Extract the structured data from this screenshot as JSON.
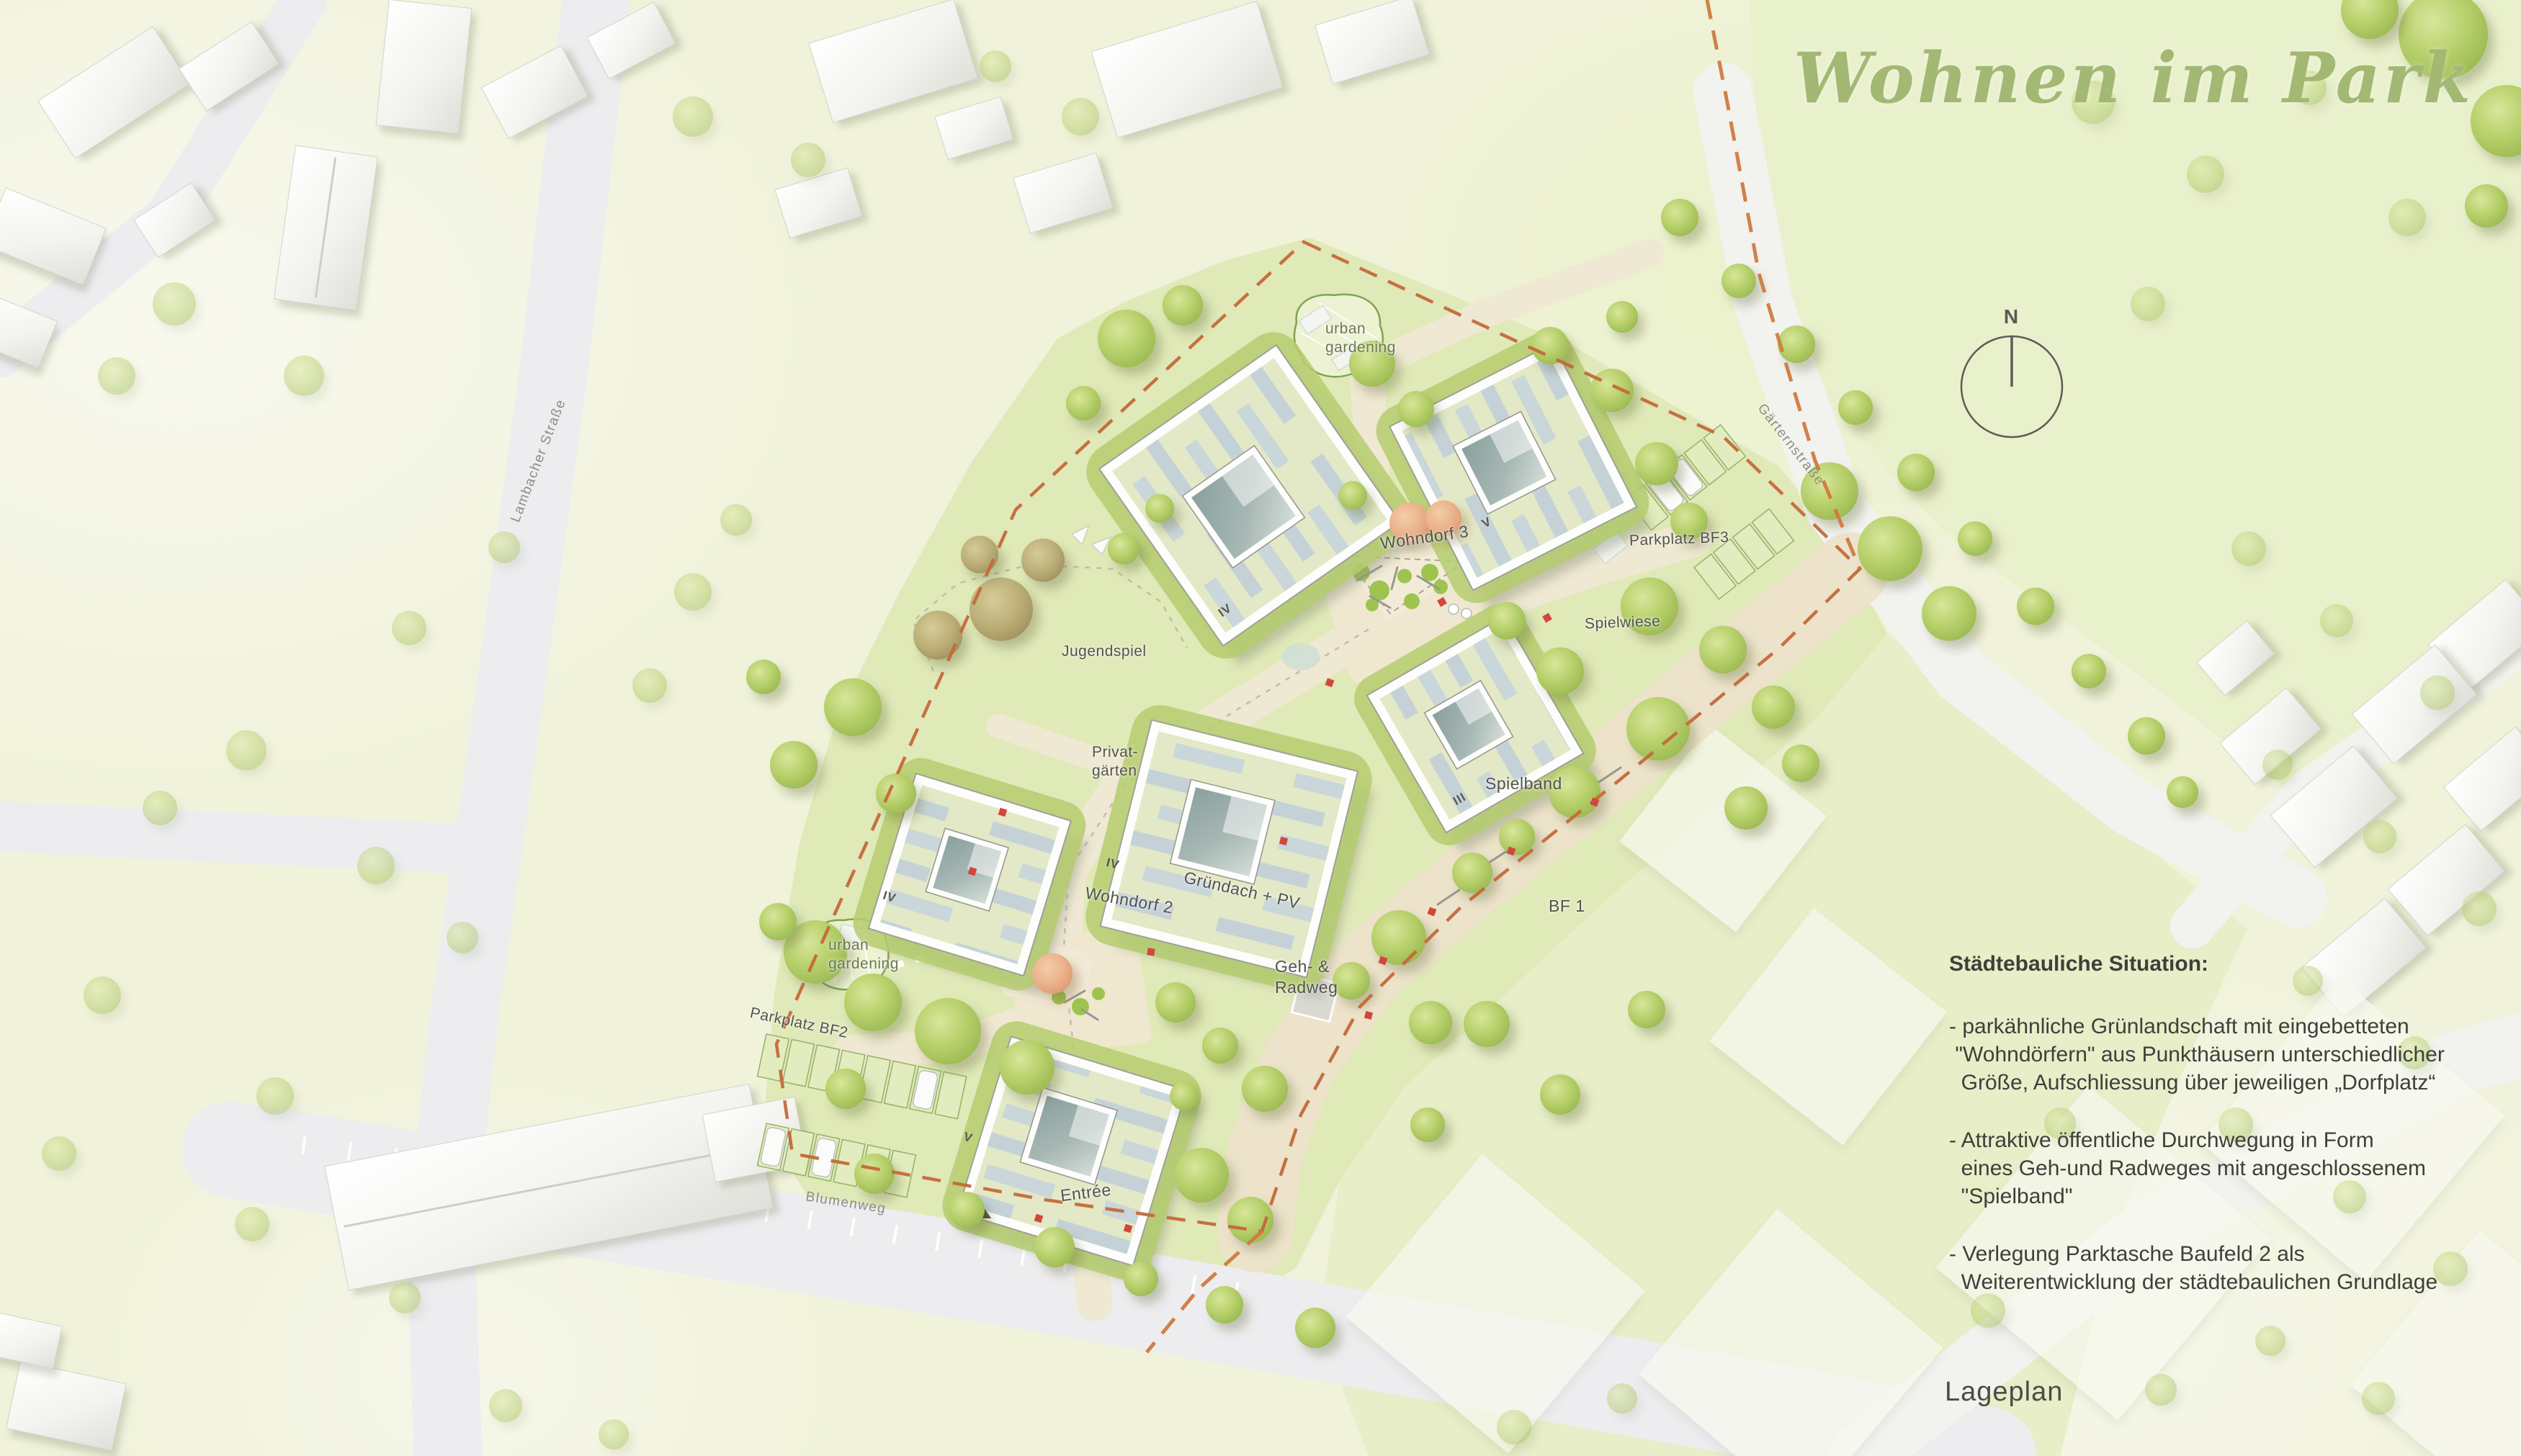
{
  "title": "Wohnen im Park",
  "caption": "Lageplan",
  "compass": {
    "north": "N"
  },
  "description": {
    "heading": "Städtebauliche Situation:",
    "bullets": [
      "- parkähnliche Grünlandschaft mit eingebetteten\n \"Wohndörfern\" aus Punkthäusern unterschiedlicher\n  Größe, Aufschliessung über jeweiligen „Dorfplatz“",
      "- Attraktive öffentliche Durchwegung in Form\n  eines Geh-und Radweges mit angeschlossenem\n  \"Spielband\"",
      "- Verlegung Parktasche Baufeld 2 als\n  Weiterentwicklung der städtebaulichen Grundlage"
    ]
  },
  "streets": {
    "lambacher": "Lambacher Straße",
    "gaertern": "Gärternstraße",
    "blumenweg": "Blumenweg"
  },
  "labels": {
    "wohndorf3": "Wohndorf 3",
    "wohndorf2": "Wohndorf 2",
    "gruendach": "Gründach + PV",
    "gehradweg": "Geh- &\nRadweg",
    "jugendspiel": "Jugendspiel",
    "privatgaerten": "Privat-\ngärten",
    "urban_gardening": "urban\ngardening",
    "parkplatz_bf3": "Parkplatz BF3",
    "parkplatz_bf2": "Parkplatz BF2",
    "spielwiese": "Spielwiese",
    "spielband": "Spielband",
    "bf1": "BF 1",
    "entree": "Entrée"
  },
  "buildings": [
    {
      "id": "wohndorf3-a",
      "floors": "IV"
    },
    {
      "id": "wohndorf3-b",
      "floors": "V"
    },
    {
      "id": "wohndorf3-c",
      "floors": "III"
    },
    {
      "id": "wohndorf2-main",
      "floors": "IV"
    },
    {
      "id": "wohndorf2-west",
      "floors": "IV"
    },
    {
      "id": "wohndorf2-south",
      "floors": "V"
    }
  ],
  "colors": {
    "title_green": "#a2b873",
    "text_grey": "#3f3f3b",
    "label_grey": "#53534c",
    "site_lawn": "#e0e9b8",
    "context_bg": "#f0f2da",
    "tree_green": "#b7d06b",
    "tree_orange": "#eab28b",
    "roof_base": "#e3e8c6",
    "pv_stripe": "#c2d1da",
    "boundary_orange": "#c4693a",
    "road_grey": "#ededf0",
    "path_beige": "#efe8d2"
  }
}
